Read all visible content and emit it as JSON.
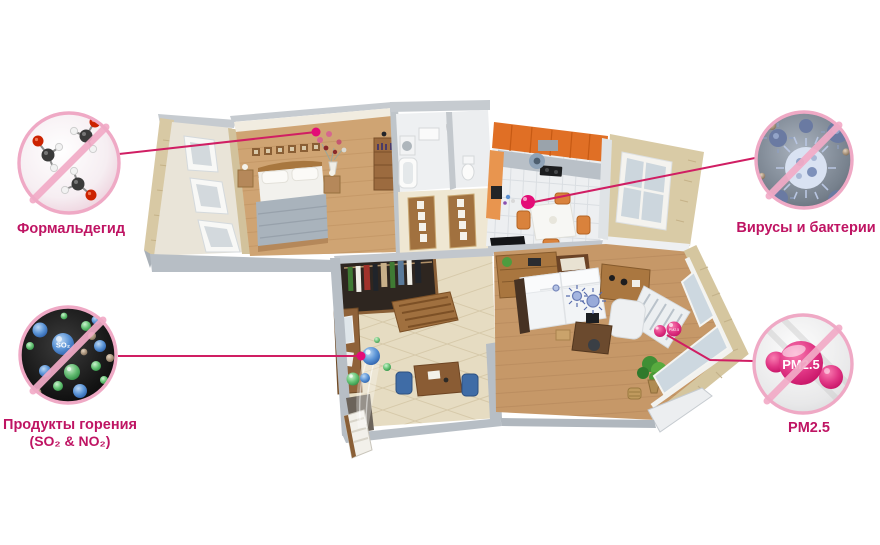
{
  "colors": {
    "accent_magenta": "#bf1463",
    "connector_line": "#d01e63",
    "ring_pink": "#efa9c5",
    "marker_dot": "#e40c77"
  },
  "callouts": {
    "formaldehyde": {
      "label": "Формальдегид"
    },
    "viruses": {
      "label": "Вирусы и бактерии"
    },
    "combustion": {
      "label": "Продукты горения",
      "label2": "(SO₂ & NO₂)",
      "particle": "SO₂"
    },
    "pm25": {
      "label": "PM2.5",
      "blob": "PM2.5",
      "marker": "PM2.5"
    }
  }
}
